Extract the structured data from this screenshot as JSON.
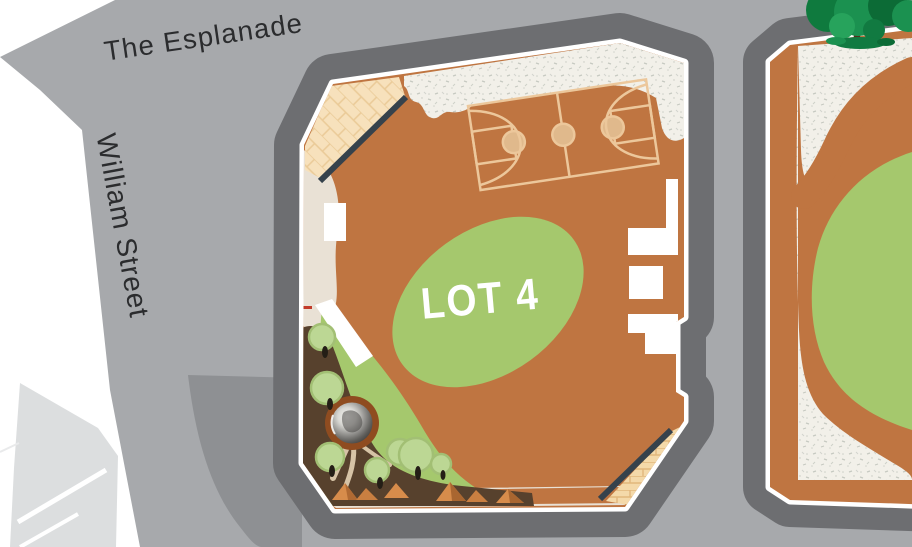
{
  "map": {
    "streets": [
      {
        "name": "The Esplanade"
      },
      {
        "name": "William Street"
      }
    ],
    "lots": [
      {
        "label": "LOT 4",
        "features": [
          "basketball-court",
          "oval-lawn",
          "playground-garden",
          "rock-pool",
          "boulders",
          "playground-trees",
          "sand-softfall",
          "brick-paving",
          "boundary-walls",
          "building-footprints"
        ]
      }
    ],
    "adjacent_lot_features": [
      "lawn",
      "sand-softfall",
      "path",
      "street-tree"
    ],
    "colors": {
      "road": "#a7a9ac",
      "footpath": "#6d6e71",
      "plaza_paving": "#8e9093",
      "lot_ground": "#bf7541",
      "lawn": "#a5c86d",
      "sand": "#f2f0e9",
      "court_lines": "#ecc79b",
      "boundary_wall": "#36424c",
      "brick_paving": "#f7e1bc",
      "garden_soil": "#57412d",
      "tree_canopy": "#bcd794",
      "street_tree_canopy": "#1b9150",
      "rock": "#d78c4b",
      "label_text": "#2b2c2e",
      "lot_label_text": "#ffffff"
    }
  }
}
